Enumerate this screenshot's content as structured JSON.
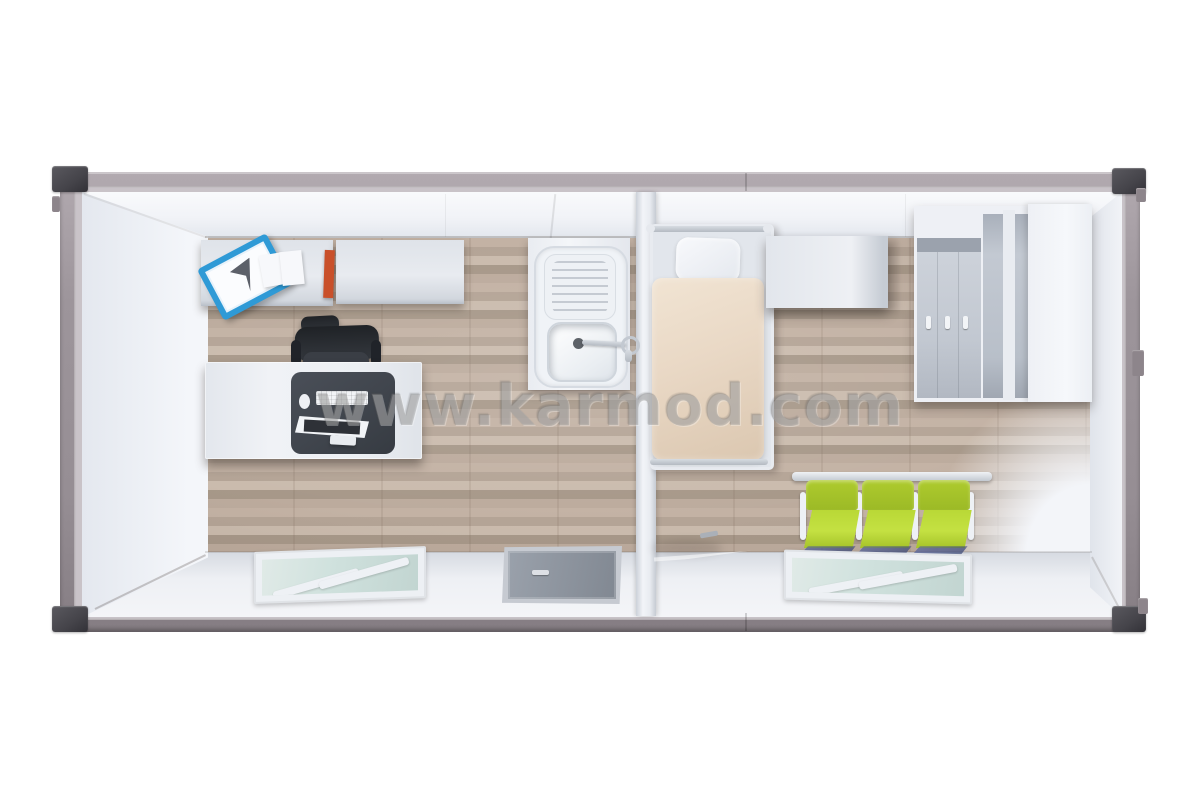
{
  "watermark": {
    "text": "www.karmod.com"
  },
  "palette": {
    "page-bg": "#ffffff",
    "frame": "#9d959b",
    "frame-dark": "#7e767c",
    "corner": "#45444a",
    "wall": "#f2f4f8",
    "wall-shade": "#dde1e8",
    "floor-a": "#c3b2a4",
    "floor-b": "#b4a496",
    "floor-c": "#cabbad",
    "floor-d": "#a79889",
    "furn-white": "#e9ecf1",
    "furn-shade": "#c9cfd7",
    "desk-pad": "#41464e",
    "chair-black": "#2a2d33",
    "folder-blue": "#2f9ad6",
    "book-orange": "#c9502a",
    "duvet": "#e9d8c5",
    "pillow": "#f3f4f8",
    "seat-green": "#b9d836",
    "seat-green-dark": "#9cba26",
    "glass": "#cfe1dd",
    "door-grey": "#939aa4",
    "door-wood": "#d7cab3",
    "watermark-grey": "#828282"
  },
  "scene": {
    "subject": "Prefabricated container cabin, top-down 3D render",
    "rooms": [
      {
        "name": "office",
        "objects": [
          "wall-cabinet",
          "wall-cabinet",
          "blue-document-folder",
          "white-papers",
          "orange-binder",
          "black-office-chair",
          "white-desk",
          "desk-pad",
          "monitor",
          "keyboard",
          "mouse",
          "window",
          "entrance-door"
        ]
      },
      {
        "name": "washroom",
        "objects": [
          "counter",
          "sink-drainboard",
          "sink-basin",
          "faucet"
        ]
      },
      {
        "name": "rest-room",
        "objects": [
          "single-bed",
          "pillow",
          "beige-duvet",
          "bedside-cabinet",
          "locker-wardrobe",
          "open-shelving-unit",
          "three-seat-waiting-bench",
          "window",
          "open-interior-wood-door"
        ]
      }
    ]
  }
}
